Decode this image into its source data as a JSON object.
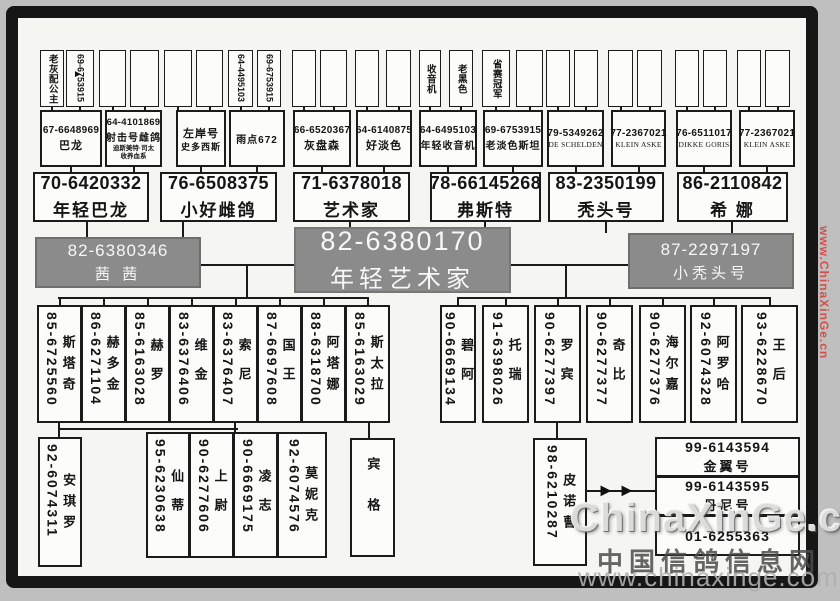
{
  "watermarks": {
    "side": "www.ChinaXinGe.cn",
    "brand": "ChinaXinGe.com",
    "site_cn": "中国信鸽信息网",
    "site_url": "www.chinaxinge.com"
  },
  "colors": {
    "box_gray": "#8b8b8b",
    "line": "#1a1a1a",
    "watermark_red": "#d23c37"
  },
  "tree": {
    "gen1": [
      {
        "x": 40,
        "w": 24,
        "num": "",
        "name": "老灰配公主"
      },
      {
        "x": 66,
        "w": 28,
        "num": "69-6753915",
        "name": ""
      },
      {
        "x": 99,
        "w": 27,
        "num": "",
        "name": ""
      },
      {
        "x": 130,
        "w": 29,
        "num": "",
        "name": ""
      },
      {
        "x": 164,
        "w": 28,
        "num": "",
        "name": ""
      },
      {
        "x": 196,
        "w": 27,
        "num": "",
        "name": ""
      },
      {
        "x": 228,
        "w": 25,
        "num": "64-4495103",
        "name": ""
      },
      {
        "x": 257,
        "w": 24,
        "num": "69-6753915",
        "name": ""
      },
      {
        "x": 292,
        "w": 24,
        "num": "",
        "name": ""
      },
      {
        "x": 320,
        "w": 27,
        "num": "",
        "name": ""
      },
      {
        "x": 355,
        "w": 24,
        "num": "",
        "name": ""
      },
      {
        "x": 386,
        "w": 25,
        "num": "",
        "name": ""
      },
      {
        "x": 419,
        "w": 22,
        "num": "",
        "name": "收音机"
      },
      {
        "x": 449,
        "w": 24,
        "num": "",
        "name": "老黑色"
      },
      {
        "x": 482,
        "w": 28,
        "num": "",
        "name": "省赛冠军"
      },
      {
        "x": 516,
        "w": 27,
        "num": "",
        "name": ""
      },
      {
        "x": 546,
        "w": 24,
        "num": "",
        "name": ""
      },
      {
        "x": 574,
        "w": 24,
        "num": "",
        "name": ""
      },
      {
        "x": 608,
        "w": 25,
        "num": "",
        "name": ""
      },
      {
        "x": 637,
        "w": 25,
        "num": "",
        "name": ""
      },
      {
        "x": 675,
        "w": 24,
        "num": "",
        "name": ""
      },
      {
        "x": 703,
        "w": 24,
        "num": "",
        "name": ""
      },
      {
        "x": 737,
        "w": 24,
        "num": "",
        "name": ""
      },
      {
        "x": 765,
        "w": 25,
        "num": "",
        "name": ""
      }
    ],
    "gen2": [
      {
        "x": 40,
        "w": 62,
        "num": "67-6648969",
        "name": "巴龙",
        "subs": []
      },
      {
        "x": 105,
        "w": 57,
        "num": "64-4101869",
        "name": "射击号雌鸽",
        "subs": [
          "迪斯美特·司太",
          "收养血系"
        ]
      },
      {
        "x": 176,
        "w": 50,
        "num": "",
        "name": "左岸号",
        "subs": [
          "史多西斯"
        ]
      },
      {
        "x": 229,
        "w": 56,
        "num": "",
        "name": "雨点672",
        "subs": []
      },
      {
        "x": 293,
        "w": 58,
        "num": "66-6520367",
        "name": "灰盘森",
        "subs": []
      },
      {
        "x": 356,
        "w": 56,
        "num": "64-6140875",
        "name": "好淡色",
        "subs": []
      },
      {
        "x": 419,
        "w": 58,
        "num": "64-6495103",
        "name": "年轻收音机",
        "subs": []
      },
      {
        "x": 483,
        "w": 60,
        "num": "69-6753915",
        "name": "老淡色斯坦",
        "subs": []
      },
      {
        "x": 547,
        "w": 57,
        "num": "79-5349262",
        "name": "DE SCHELDEN",
        "subs": []
      },
      {
        "x": 611,
        "w": 55,
        "num": "77-2367021",
        "name": "KLEIN ASKE",
        "subs": []
      },
      {
        "x": 676,
        "w": 56,
        "num": "76-6511017",
        "name": "DIKKE GORIS",
        "subs": []
      },
      {
        "x": 739,
        "w": 56,
        "num": "77-2367021",
        "name": "KLEIN ASKE",
        "subs": []
      }
    ],
    "gen3": [
      {
        "x": 33,
        "w": 116,
        "num": "70-6420332",
        "name": "年轻巴龙"
      },
      {
        "x": 160,
        "w": 117,
        "num": "76-6508375",
        "name": "小好雌鸽"
      },
      {
        "x": 293,
        "w": 117,
        "num": "71-6378018",
        "name": "艺术家"
      },
      {
        "x": 430,
        "w": 111,
        "num": "78-66145268",
        "name": "弗斯特"
      },
      {
        "x": 548,
        "w": 116,
        "num": "83-2350199",
        "name": "秃头号"
      },
      {
        "x": 677,
        "w": 111,
        "num": "86-2110842",
        "name": "希 娜"
      }
    ],
    "couple": {
      "left": {
        "num": "82-6380346",
        "name": "茜 茜"
      },
      "center": {
        "num": "82-6380170",
        "name": "年轻艺术家"
      },
      "right": {
        "num": "87-2297197",
        "name": "小秃头号"
      }
    },
    "gen4": [
      {
        "x": 37,
        "w": 45,
        "num": "85-6725560",
        "name": "斯塔奇"
      },
      {
        "x": 81,
        "w": 45,
        "num": "86-6271104",
        "name": "赫多金"
      },
      {
        "x": 125,
        "w": 45,
        "num": "85-6163028",
        "name": "赫罗"
      },
      {
        "x": 169,
        "w": 45,
        "num": "83-6376406",
        "name": "维金"
      },
      {
        "x": 213,
        "w": 45,
        "num": "83-6376407",
        "name": "索尼"
      },
      {
        "x": 257,
        "w": 45,
        "num": "87-6697608",
        "name": "国王"
      },
      {
        "x": 301,
        "w": 45,
        "num": "88-6318700",
        "name": "阿塔娜"
      },
      {
        "x": 345,
        "w": 45,
        "num": "85-6163029",
        "name": "斯太拉"
      },
      {
        "x": 440,
        "w": 36,
        "num": "90-6669134",
        "name": "碧阿"
      },
      {
        "x": 482,
        "w": 47,
        "num": "91-6398026",
        "name": "托瑞"
      },
      {
        "x": 534,
        "w": 47,
        "num": "90-6277397",
        "name": "罗宾"
      },
      {
        "x": 586,
        "w": 47,
        "num": "90-6277377",
        "name": "奇比"
      },
      {
        "x": 639,
        "w": 47,
        "num": "90-6277376",
        "name": "海尔嘉"
      },
      {
        "x": 690,
        "w": 47,
        "num": "92-6074328",
        "name": "阿罗哈"
      },
      {
        "x": 741,
        "w": 57,
        "num": "93-6228670",
        "name": "王后"
      }
    ],
    "gen5": [
      {
        "x": 38,
        "y": 437,
        "w": 44,
        "h": 130,
        "num": "92-6074311",
        "name": "安琪罗"
      },
      {
        "x": 146,
        "y": 432,
        "w": 44,
        "h": 126,
        "num": "95-6230638",
        "name": "仙蒂"
      },
      {
        "x": 189,
        "y": 432,
        "w": 45,
        "h": 126,
        "num": "90-6277606",
        "name": "上尉"
      },
      {
        "x": 233,
        "y": 432,
        "w": 45,
        "h": 126,
        "num": "90-6669175",
        "name": "凌志"
      },
      {
        "x": 277,
        "y": 432,
        "w": 50,
        "h": 126,
        "num": "92-6074576",
        "name": "莫妮克"
      },
      {
        "x": 350,
        "y": 438,
        "w": 45,
        "h": 119,
        "num": "",
        "name": "宾格"
      },
      {
        "x": 533,
        "y": 438,
        "w": 54,
        "h": 128,
        "num": "98-6210287",
        "name": "皮诺曹"
      }
    ],
    "stack": [
      {
        "num": "99-6143594",
        "name": "金翼号"
      },
      {
        "num": "99-6143595",
        "name": "丹尼号"
      },
      {
        "num": "01-6255363",
        "name": ""
      }
    ]
  }
}
